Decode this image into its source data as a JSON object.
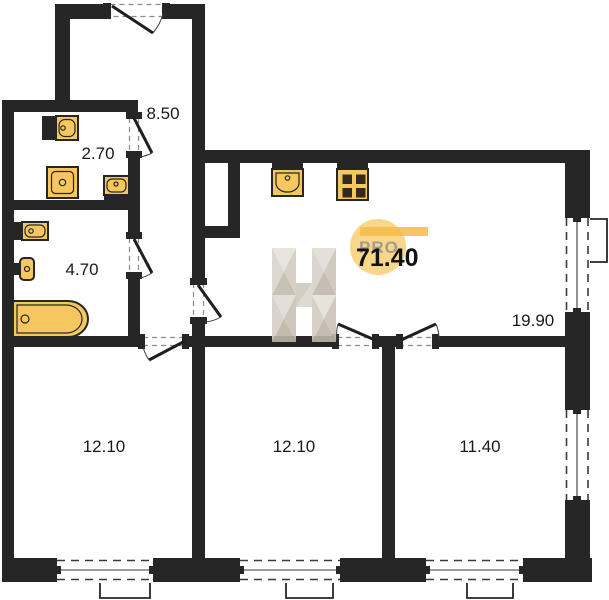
{
  "plan": {
    "title": "Apartment floor plan",
    "total_area": "71.40",
    "brand": "PRO",
    "rooms": [
      {
        "id": "hallway",
        "area": "8.50"
      },
      {
        "id": "bathroom-small",
        "area": "2.70"
      },
      {
        "id": "bathroom-large",
        "area": "4.70"
      },
      {
        "id": "living-kitchen",
        "area": "19.90"
      },
      {
        "id": "bedroom-left",
        "area": "12.10"
      },
      {
        "id": "bedroom-middle",
        "area": "12.10"
      },
      {
        "id": "bedroom-right",
        "area": "11.40"
      }
    ],
    "fixtures": [
      "sink",
      "shower",
      "sink-small",
      "sink",
      "toilet",
      "bathtub",
      "kitchen-sink",
      "stove"
    ],
    "colors": {
      "wall": "#262626",
      "fixture_fill": "#f6c75f",
      "fixture_stroke": "#262626",
      "logo_circle": "#f8cd6e",
      "logo_bar": "#f5bb49",
      "brand_text": "#a29b91",
      "label_text": "#1a1a1a",
      "watermark_grays": [
        "#e6e2db",
        "#d2cbc0",
        "#c3bbaf",
        "#d9d3ca"
      ]
    }
  }
}
